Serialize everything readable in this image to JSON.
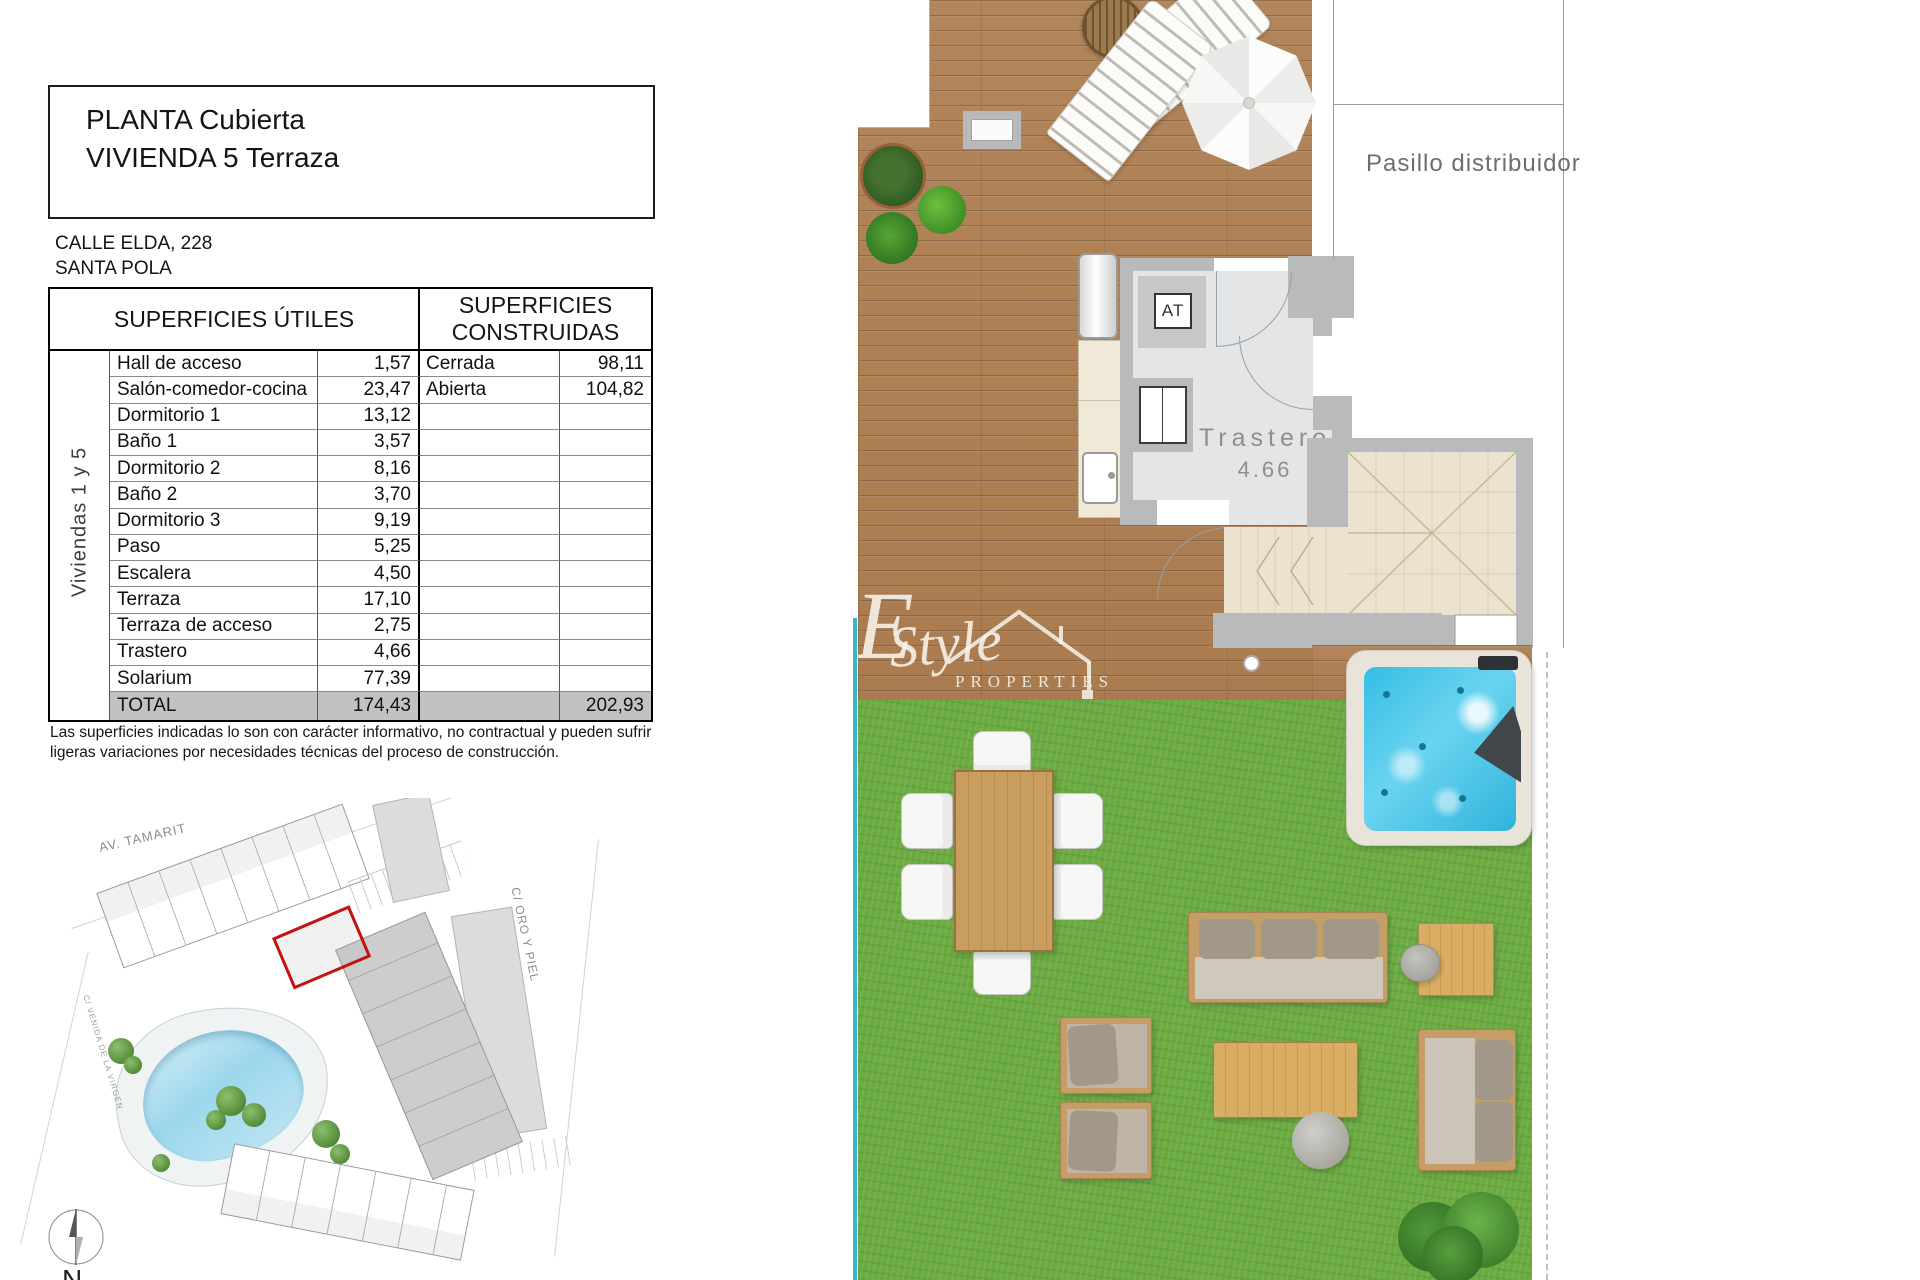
{
  "document": {
    "title_line1": "PLANTA Cubierta",
    "title_line2": "VIVIENDA 5 Terraza",
    "address_line1": "CALLE ELDA, 228",
    "address_line2": "SANTA POLA",
    "table": {
      "header_left": "SUPERFICIES ÚTILES",
      "header_right": "SUPERFICIES CONSTRUIDAS",
      "group_label": "Viviendas 1 y 5",
      "rows": [
        {
          "name": "Hall de acceso",
          "value": "1,57",
          "name2": "Cerrada",
          "value2": "98,11"
        },
        {
          "name": "Salón-comedor-cocina",
          "value": "23,47",
          "name2": "Abierta",
          "value2": "104,82"
        },
        {
          "name": "Dormitorio 1",
          "value": "13,12",
          "name2": "",
          "value2": ""
        },
        {
          "name": "Baño 1",
          "value": "3,57",
          "name2": "",
          "value2": ""
        },
        {
          "name": "Dormitorio 2",
          "value": "8,16",
          "name2": "",
          "value2": ""
        },
        {
          "name": "Baño 2",
          "value": "3,70",
          "name2": "",
          "value2": ""
        },
        {
          "name": "Dormitorio 3",
          "value": "9,19",
          "name2": "",
          "value2": ""
        },
        {
          "name": "Paso",
          "value": "5,25",
          "name2": "",
          "value2": ""
        },
        {
          "name": "Escalera",
          "value": "4,50",
          "name2": "",
          "value2": ""
        },
        {
          "name": "Terraza",
          "value": "17,10",
          "name2": "",
          "value2": ""
        },
        {
          "name": "Terraza de acceso",
          "value": "2,75",
          "name2": "",
          "value2": ""
        },
        {
          "name": "Trastero",
          "value": "4,66",
          "name2": "",
          "value2": ""
        },
        {
          "name": "Solarium",
          "value": "77,39",
          "name2": "",
          "value2": ""
        }
      ],
      "total": {
        "name": "TOTAL",
        "value": "174,43",
        "name2": "",
        "value2": "202,93"
      }
    },
    "disclaimer_line1": "Las superficies indicadas lo son con carácter informativo, no contractual y pueden sufrir",
    "disclaimer_line2": "ligeras variaciones por necesidades técnicas del proceso de construcción."
  },
  "floor_plan": {
    "corridor_label": "Pasillo distribuidor",
    "storage_label": "Trastero",
    "storage_area": "4.66",
    "at_label": "AT"
  },
  "site_plan": {
    "street_top": "AV. TAMARIT",
    "street_right": "C/ ORO Y PIEL",
    "street_left": "C/ VENIDA DE LA VIRGEN",
    "compass_label": "N"
  },
  "watermark": {
    "glyph": "E",
    "brand": "Style",
    "subtitle": "PROPERTIES"
  },
  "colors": {
    "highlight_red": "#c31212",
    "grass_green": "#6cab42",
    "deck_wood": "#af8156",
    "jacuzzi_water": "#3ec4e8",
    "pool_blue": "#9bd7ec",
    "wall_gray": "#b9babc",
    "tile_beige": "#ebe3d0",
    "total_row_bg": "#c2c2c2"
  }
}
